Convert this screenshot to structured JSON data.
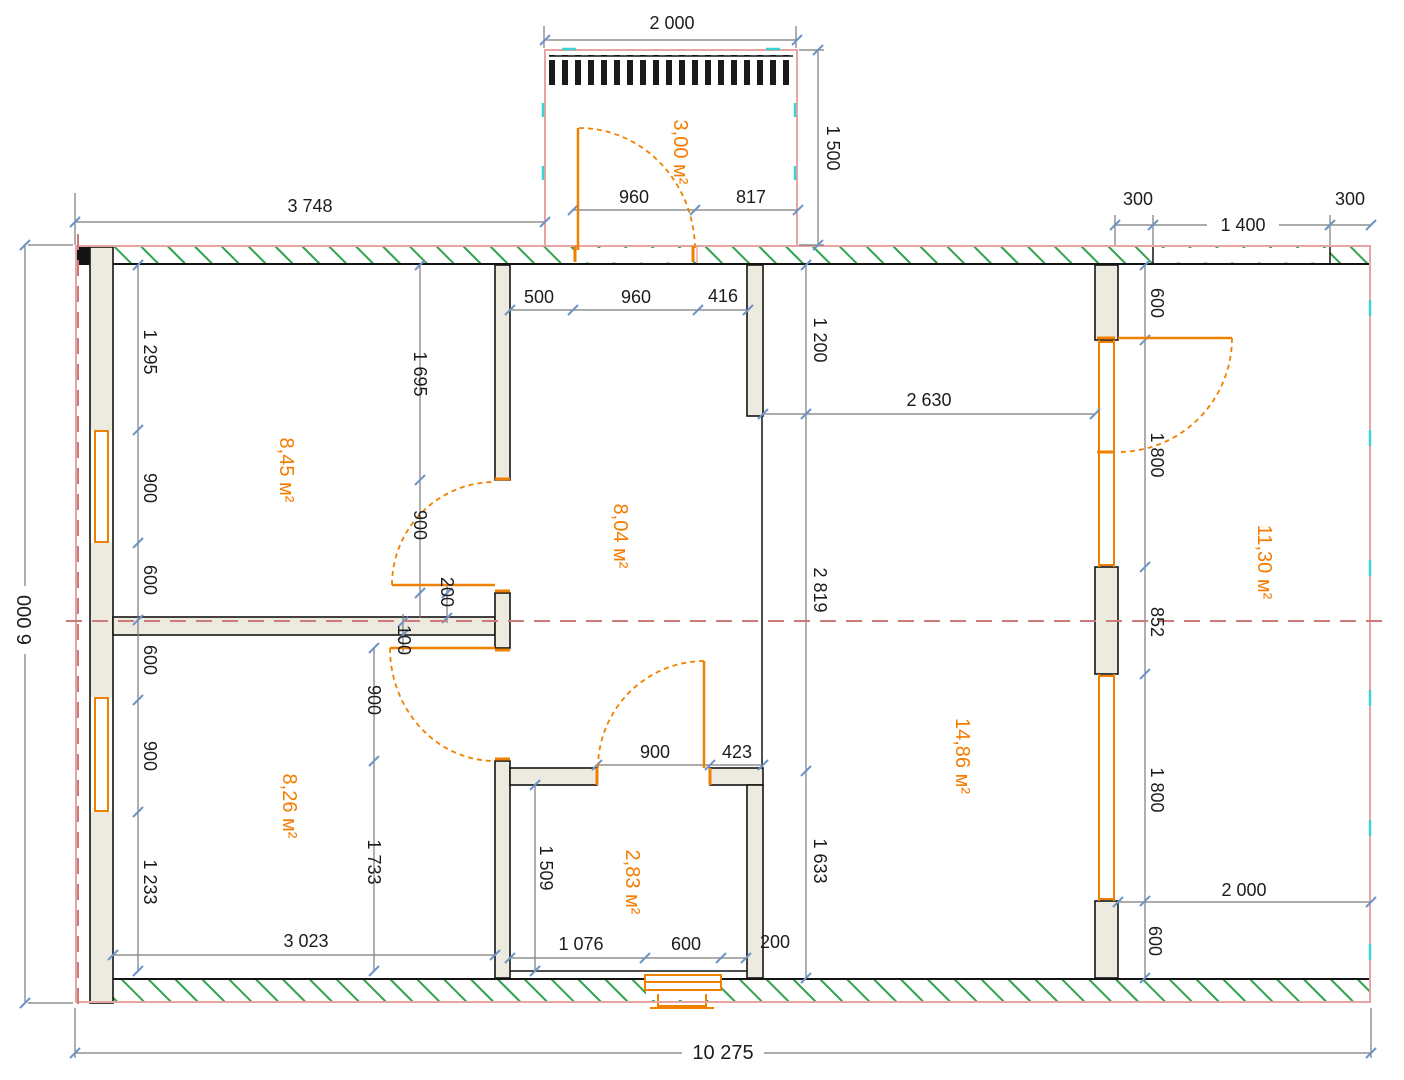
{
  "drawing": {
    "type": "floor-plan",
    "colors": {
      "wall_fill": "#edeadf",
      "wall_stroke": "#1a1a1a",
      "hatch_green": "#2fa34c",
      "outline_pink": "#e8a3a3",
      "axis_red": "#cc7b7b",
      "accent_orange": "#f57c00",
      "door_orange": "#f08100",
      "dim_gray": "#7a7a7a",
      "tick_blue": "#6e93c8",
      "mark_cyan": "#3ed3d3"
    }
  },
  "areas": {
    "porch": "3,00 м²",
    "room_top_left": "8,45 м²",
    "hall": "8,04 м²",
    "room_bottom_left": "8,26 м²",
    "bath": "2,83 м²",
    "living": "14,86 м²",
    "room_right": "11,30 м²"
  },
  "dims": {
    "overall_w": "10 275",
    "overall_h": "6 000",
    "porch_w": "2 000",
    "porch_d": "1 500",
    "porch_door": "960",
    "porch_side": "817",
    "left_top": "3 748",
    "tr_300a": "300",
    "tr_1400": "1 400",
    "tr_300b": "300",
    "hall_500": "500",
    "hall_960": "960",
    "hall_416": "416",
    "liv_2630": "2 630",
    "stub_1200": "1 200",
    "liv_2819": "2 819",
    "liv_1633": "1 633",
    "lw_1295": "1 295",
    "lw_900a": "900",
    "lw_600a": "600",
    "lw_600b": "600",
    "lw_900b": "900",
    "lw_1233": "1 233",
    "mid_1695": "1 695",
    "mid_900a": "900",
    "mid_200": "200",
    "mid_100": "100",
    "mid_900b": "900",
    "mid_1733": "1 733",
    "bath_900": "900",
    "bath_423": "423",
    "bath_1509": "1 509",
    "bath_1076": "1 076",
    "bath_600": "600",
    "bath_200": "200",
    "bl_3023": "3 023",
    "r_600a": "600",
    "r_1800a": "1 800",
    "r_852": "852",
    "r_1800b": "1 800",
    "r_600b": "600",
    "br_2000": "2 000",
    "br_600": "600"
  }
}
